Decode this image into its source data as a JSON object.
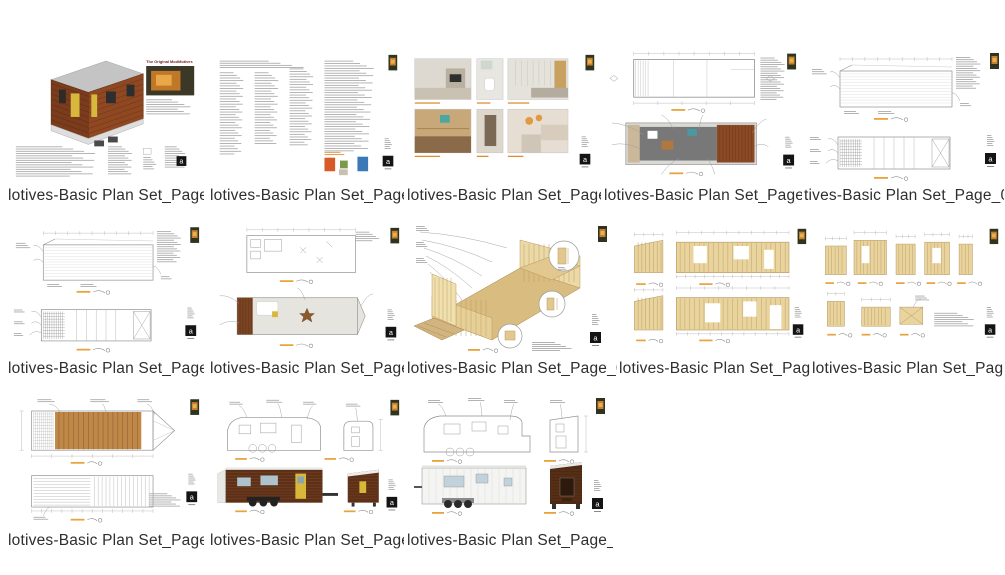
{
  "window": {
    "background": "#ffffff"
  },
  "palette": {
    "accent_orange": "#e08a2e",
    "scalebar_orange": "#e8a33c",
    "wood_dark": "#5d3018",
    "wood_mid": "#8a4a26",
    "framing_tan": "#ead49e",
    "line_gray": "#8f8f8f",
    "sheet_block": "#141414"
  },
  "gallery": {
    "sheet_logo_letter": "a",
    "items": [
      {
        "id": "page-01",
        "type": "cover",
        "caption": "lotives-Basic Plan Set_Page_0",
        "cover_title": "The Original ModMotives"
      },
      {
        "id": "page-02",
        "type": "specs",
        "caption": "lotives-Basic Plan Set_Page_0"
      },
      {
        "id": "page-03",
        "type": "photos",
        "caption": "lotives-Basic Plan Set_Page_0"
      },
      {
        "id": "page-04",
        "type": "floorplan",
        "caption": "lotives-Basic Plan Set_Page_0"
      },
      {
        "id": "page-05",
        "type": "elevations",
        "caption": "tives-Basic Plan Set_Page_05"
      },
      {
        "id": "page-06",
        "type": "elevations",
        "caption": "lotives-Basic Plan Set_Page_0"
      },
      {
        "id": "page-07",
        "type": "loftplan",
        "caption": "lotives-Basic Plan Set_Page_0"
      },
      {
        "id": "page-08",
        "type": "isoframing",
        "caption": "lotives-Basic Plan Set_Page_0"
      },
      {
        "id": "page-09",
        "type": "wallslong",
        "caption": "lotives-Basic Plan Set_Page_0"
      },
      {
        "id": "page-10",
        "type": "wallssmall",
        "caption": "lotives-Basic Plan Set_Page_0"
      },
      {
        "id": "page-11",
        "type": "roofplan",
        "caption": "lotives-Basic Plan Set_Page_1"
      },
      {
        "id": "page-12",
        "type": "extelev1",
        "caption": "lotives-Basic Plan Set_Page_1"
      },
      {
        "id": "page-13",
        "type": "extelev2",
        "caption": "lotives-Basic Plan Set_Page_1"
      }
    ]
  }
}
